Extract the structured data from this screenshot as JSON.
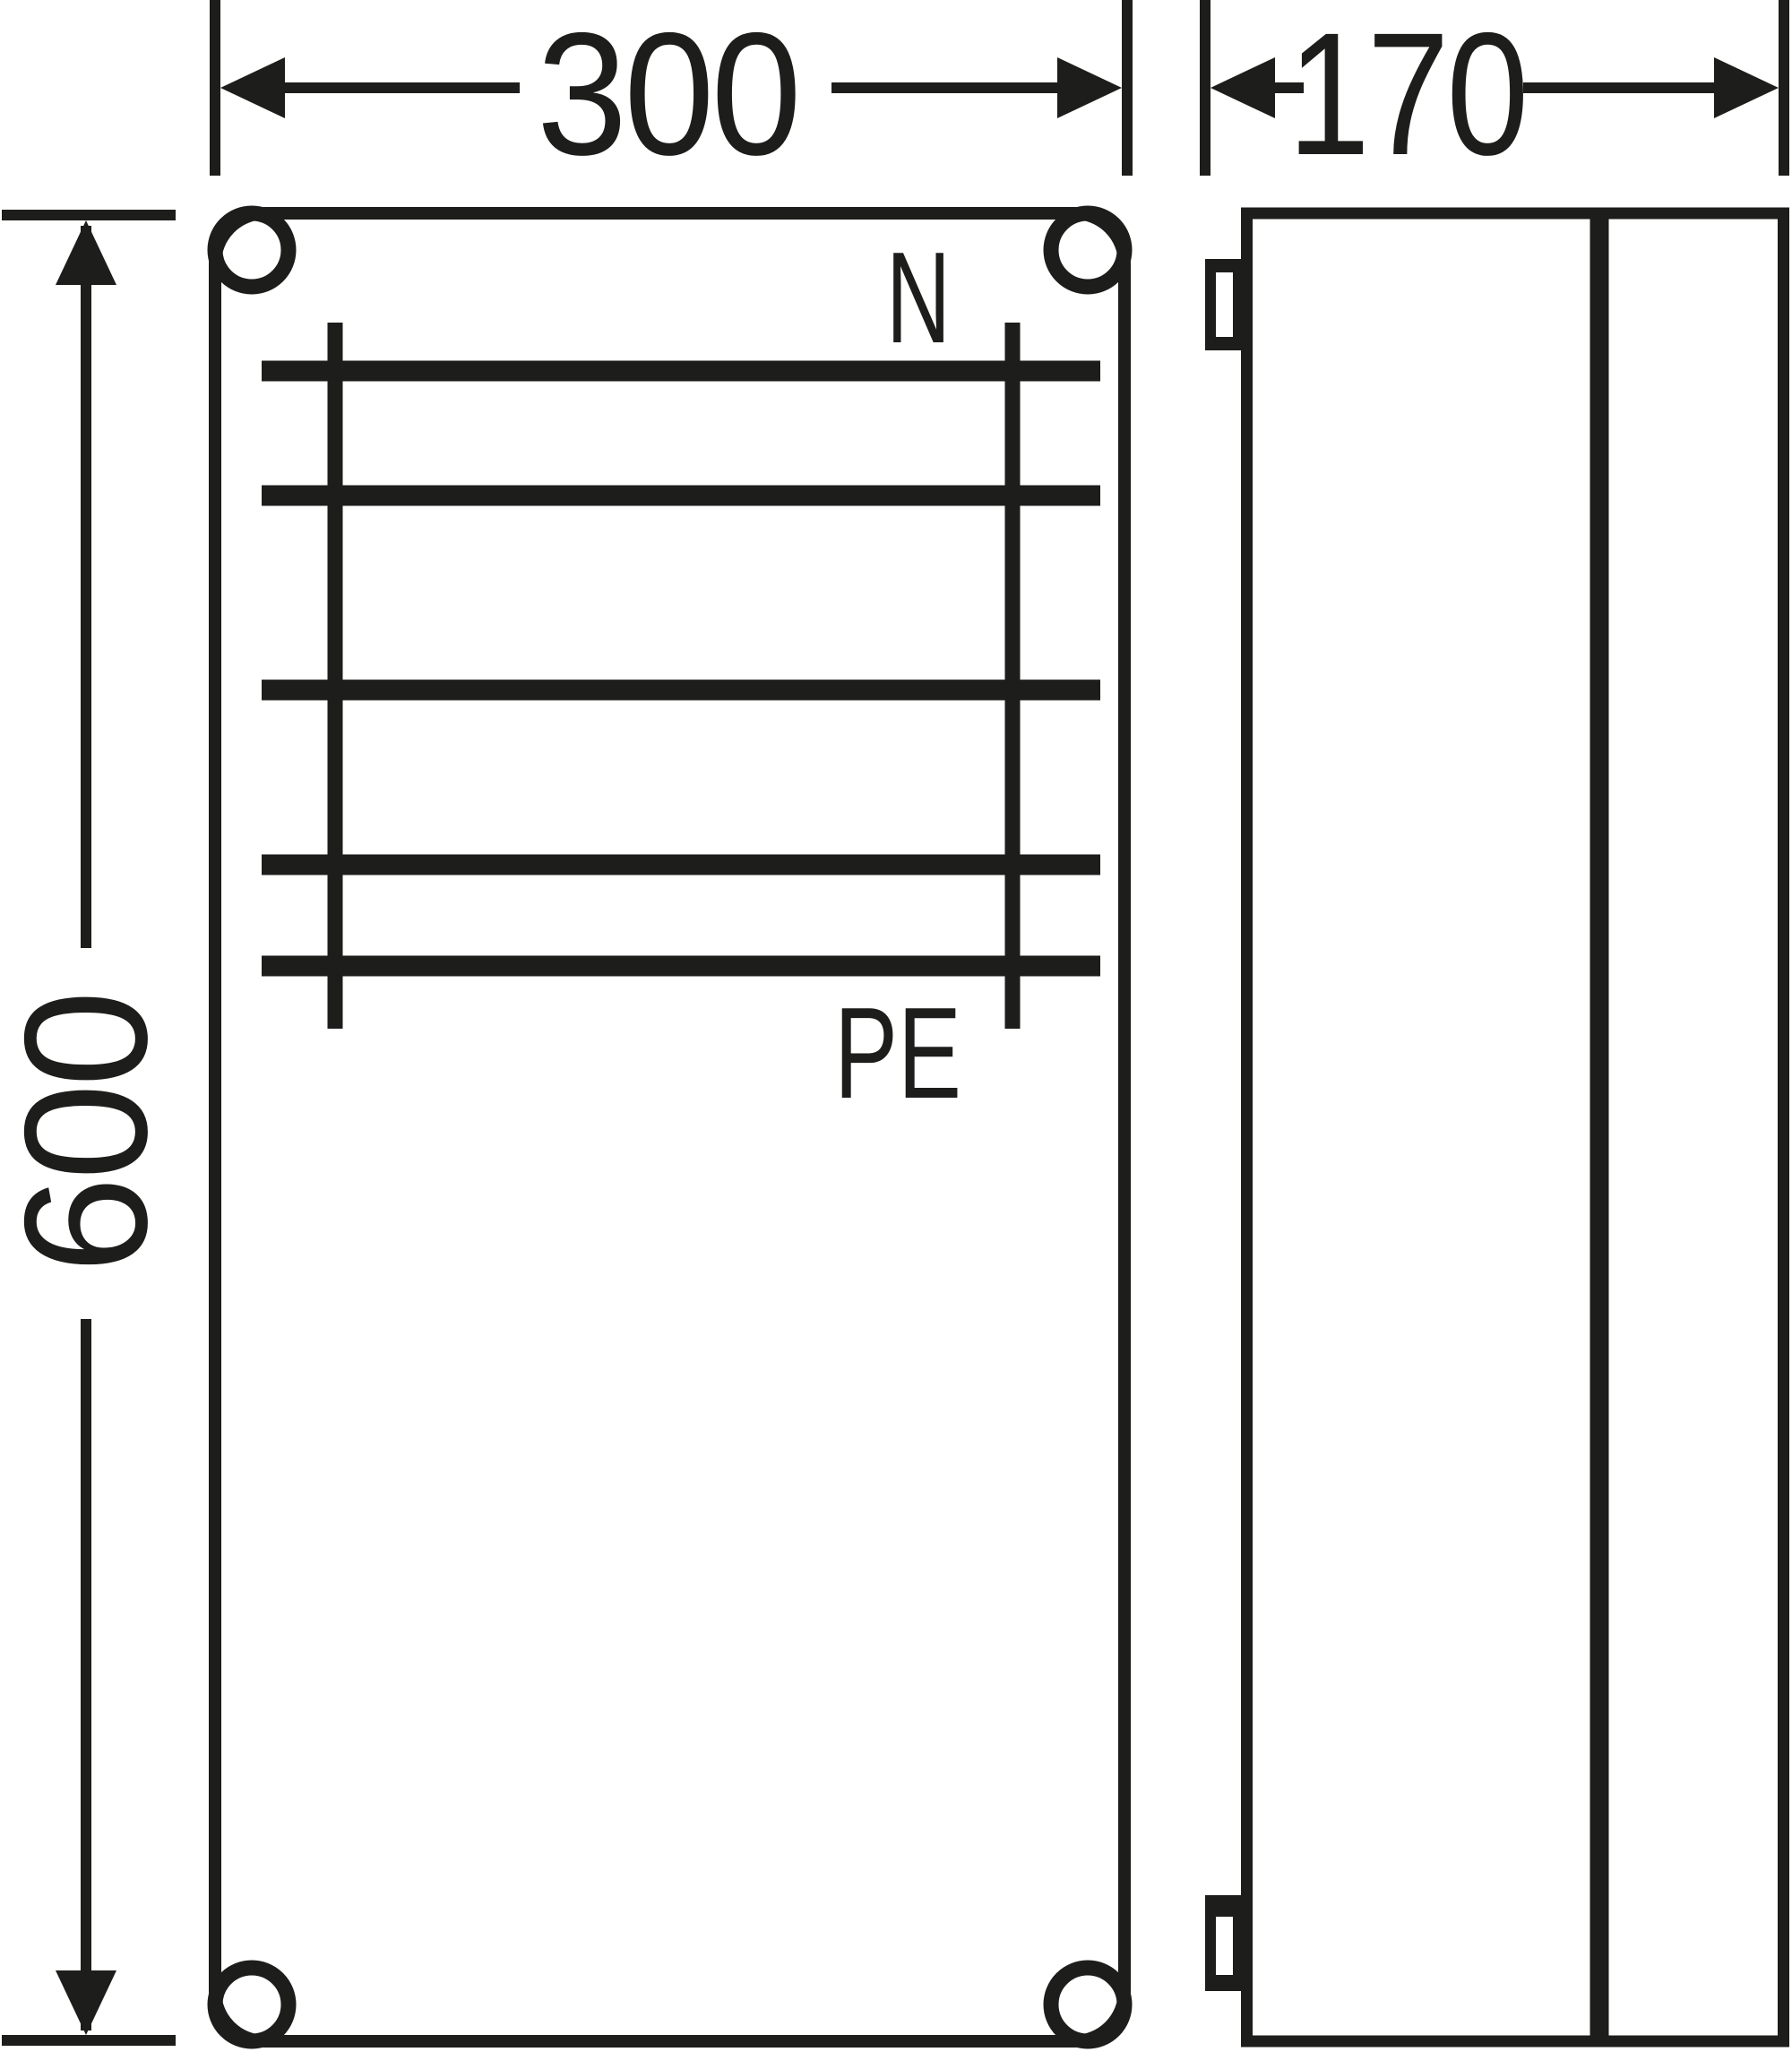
{
  "colors": {
    "line": "#1d1d1b",
    "background": "#ffffff"
  },
  "dimensions": {
    "front_width": "300",
    "front_height": "600",
    "side_depth": "170"
  },
  "busbar_labels": {
    "neutral": "N",
    "protective_earth": "PE"
  }
}
